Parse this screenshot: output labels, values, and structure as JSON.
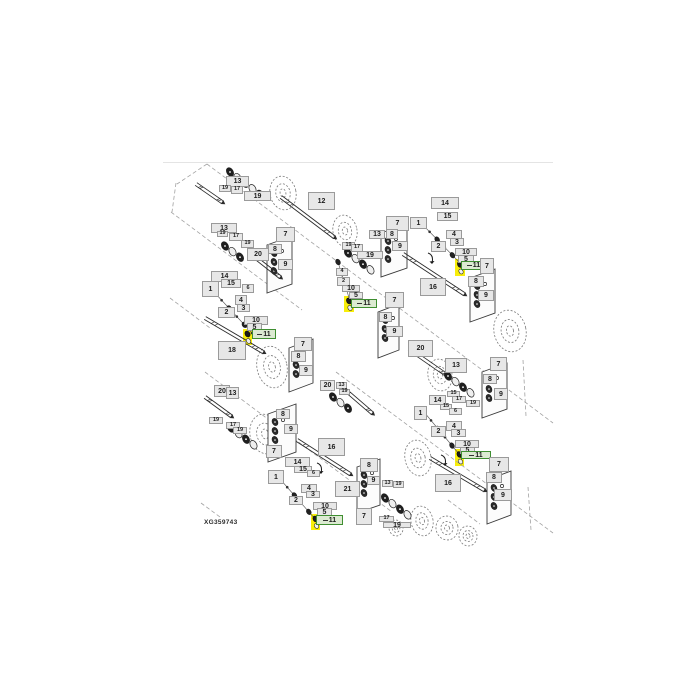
{
  "figure": {
    "code": "XG359743"
  },
  "colors": {
    "box_fill": "#e7e7e7",
    "box_border": "#9a9a9a",
    "highlight_fill": "#dcead2",
    "highlight_border": "#3f8e31",
    "highlight_marker": "#f8ee0a",
    "line": "#2b2b2b",
    "wheel": "#7a7a7a",
    "dash": "#a2a2a2",
    "divider": "#e4e4e4"
  },
  "divider": {
    "x1": 163,
    "y": 162,
    "x2": 553
  },
  "figcode_pos": {
    "x": 204,
    "y": 519
  },
  "callouts": [
    {
      "t": "13",
      "x": 226,
      "y": 176,
      "w": 23,
      "h": 11
    },
    {
      "t": "19",
      "x": 219,
      "y": 185,
      "w": 12,
      "h": 7,
      "k": "s"
    },
    {
      "t": "17",
      "x": 231,
      "y": 186,
      "w": 12,
      "h": 8,
      "k": "s"
    },
    {
      "t": "19",
      "x": 244,
      "y": 191,
      "w": 27,
      "h": 10
    },
    {
      "t": "12",
      "x": 308,
      "y": 192,
      "w": 27,
      "h": 18
    },
    {
      "t": "7",
      "x": 386,
      "y": 216,
      "w": 23,
      "h": 15
    },
    {
      "t": "13",
      "x": 369,
      "y": 230,
      "w": 16,
      "h": 9
    },
    {
      "t": "8",
      "x": 386,
      "y": 229,
      "w": 12,
      "h": 10
    },
    {
      "t": "9",
      "x": 392,
      "y": 241,
      "w": 16,
      "h": 10
    },
    {
      "t": "19",
      "x": 342,
      "y": 242,
      "w": 13,
      "h": 8,
      "k": "s"
    },
    {
      "t": "17",
      "x": 351,
      "y": 244,
      "w": 12,
      "h": 8,
      "k": "s"
    },
    {
      "t": "19",
      "x": 357,
      "y": 251,
      "w": 26,
      "h": 8
    },
    {
      "t": "14",
      "x": 431,
      "y": 197,
      "w": 28,
      "h": 12
    },
    {
      "t": "15",
      "x": 437,
      "y": 212,
      "w": 21,
      "h": 9
    },
    {
      "t": "1",
      "x": 410,
      "y": 217,
      "w": 17,
      "h": 12
    },
    {
      "t": "4",
      "x": 446,
      "y": 230,
      "w": 16,
      "h": 9
    },
    {
      "t": "3",
      "x": 450,
      "y": 238,
      "w": 14,
      "h": 8
    },
    {
      "t": "2",
      "x": 431,
      "y": 241,
      "w": 15,
      "h": 11
    },
    {
      "t": "10",
      "x": 455,
      "y": 248,
      "w": 22,
      "h": 8
    },
    {
      "t": "5",
      "x": 458,
      "y": 255,
      "w": 16,
      "h": 8
    },
    {
      "t": "11",
      "x": 461,
      "y": 261,
      "w": 25,
      "h": 9,
      "k": "h"
    },
    {
      "t": "7",
      "x": 480,
      "y": 258,
      "w": 14,
      "h": 16
    },
    {
      "t": "8",
      "x": 468,
      "y": 276,
      "w": 16,
      "h": 11
    },
    {
      "t": "9",
      "x": 478,
      "y": 290,
      "w": 16,
      "h": 11
    },
    {
      "t": "16",
      "x": 420,
      "y": 278,
      "w": 26,
      "h": 18
    },
    {
      "t": "13",
      "x": 211,
      "y": 223,
      "w": 26,
      "h": 10
    },
    {
      "t": "19",
      "x": 217,
      "y": 231,
      "w": 11,
      "h": 6,
      "k": "s"
    },
    {
      "t": "17",
      "x": 229,
      "y": 233,
      "w": 14,
      "h": 8,
      "k": "s"
    },
    {
      "t": "19",
      "x": 241,
      "y": 240,
      "w": 13,
      "h": 8,
      "k": "s"
    },
    {
      "t": "20",
      "x": 247,
      "y": 248,
      "w": 22,
      "h": 13
    },
    {
      "t": "7",
      "x": 276,
      "y": 227,
      "w": 19,
      "h": 15
    },
    {
      "t": "8",
      "x": 268,
      "y": 244,
      "w": 14,
      "h": 10
    },
    {
      "t": "9",
      "x": 278,
      "y": 259,
      "w": 15,
      "h": 11
    },
    {
      "t": "14",
      "x": 211,
      "y": 271,
      "w": 27,
      "h": 11
    },
    {
      "t": "15",
      "x": 221,
      "y": 279,
      "w": 20,
      "h": 9
    },
    {
      "t": "1",
      "x": 202,
      "y": 281,
      "w": 17,
      "h": 16
    },
    {
      "t": "6",
      "x": 242,
      "y": 284,
      "w": 12,
      "h": 9,
      "k": "s"
    },
    {
      "t": "4",
      "x": 235,
      "y": 295,
      "w": 12,
      "h": 10
    },
    {
      "t": "3",
      "x": 237,
      "y": 304,
      "w": 13,
      "h": 8
    },
    {
      "t": "2",
      "x": 218,
      "y": 307,
      "w": 17,
      "h": 11
    },
    {
      "t": "10",
      "x": 244,
      "y": 316,
      "w": 24,
      "h": 9
    },
    {
      "t": "5",
      "x": 247,
      "y": 323,
      "w": 15,
      "h": 8
    },
    {
      "t": "11",
      "x": 252,
      "y": 329,
      "w": 24,
      "h": 10,
      "k": "h"
    },
    {
      "t": "18",
      "x": 218,
      "y": 341,
      "w": 28,
      "h": 19
    },
    {
      "t": "4",
      "x": 336,
      "y": 268,
      "w": 12,
      "h": 8,
      "k": "s"
    },
    {
      "t": "2",
      "x": 337,
      "y": 277,
      "w": 13,
      "h": 9,
      "k": "s"
    },
    {
      "t": "10",
      "x": 342,
      "y": 285,
      "w": 18,
      "h": 7
    },
    {
      "t": "5",
      "x": 349,
      "y": 292,
      "w": 14,
      "h": 7
    },
    {
      "t": "11",
      "x": 351,
      "y": 299,
      "w": 26,
      "h": 9,
      "k": "h"
    },
    {
      "t": "7",
      "x": 385,
      "y": 292,
      "w": 19,
      "h": 16
    },
    {
      "t": "8",
      "x": 379,
      "y": 312,
      "w": 13,
      "h": 10
    },
    {
      "t": "9",
      "x": 386,
      "y": 326,
      "w": 17,
      "h": 11
    },
    {
      "t": "7",
      "x": 294,
      "y": 337,
      "w": 18,
      "h": 14
    },
    {
      "t": "8",
      "x": 291,
      "y": 351,
      "w": 15,
      "h": 11
    },
    {
      "t": "9",
      "x": 299,
      "y": 365,
      "w": 14,
      "h": 11
    },
    {
      "t": "20",
      "x": 320,
      "y": 380,
      "w": 15,
      "h": 11
    },
    {
      "t": "13",
      "x": 336,
      "y": 382,
      "w": 11,
      "h": 7,
      "k": "s"
    },
    {
      "t": "19",
      "x": 339,
      "y": 389,
      "w": 11,
      "h": 6,
      "k": "s"
    },
    {
      "t": "20",
      "x": 408,
      "y": 340,
      "w": 25,
      "h": 17
    },
    {
      "t": "13",
      "x": 445,
      "y": 358,
      "w": 22,
      "h": 15
    },
    {
      "t": "7",
      "x": 490,
      "y": 357,
      "w": 17,
      "h": 14
    },
    {
      "t": "8",
      "x": 483,
      "y": 374,
      "w": 14,
      "h": 10
    },
    {
      "t": "9",
      "x": 494,
      "y": 388,
      "w": 14,
      "h": 12
    },
    {
      "t": "14",
      "x": 429,
      "y": 395,
      "w": 17,
      "h": 10
    },
    {
      "t": "15",
      "x": 447,
      "y": 391,
      "w": 13,
      "h": 6,
      "k": "s"
    },
    {
      "t": "17",
      "x": 452,
      "y": 396,
      "w": 14,
      "h": 7,
      "k": "s"
    },
    {
      "t": "19",
      "x": 466,
      "y": 400,
      "w": 14,
      "h": 7,
      "k": "s"
    },
    {
      "t": "15",
      "x": 440,
      "y": 404,
      "w": 12,
      "h": 6,
      "k": "s"
    },
    {
      "t": "6",
      "x": 449,
      "y": 408,
      "w": 13,
      "h": 7,
      "k": "s"
    },
    {
      "t": "1",
      "x": 414,
      "y": 406,
      "w": 13,
      "h": 14
    },
    {
      "t": "4",
      "x": 446,
      "y": 421,
      "w": 16,
      "h": 10
    },
    {
      "t": "3",
      "x": 451,
      "y": 429,
      "w": 15,
      "h": 8
    },
    {
      "t": "2",
      "x": 431,
      "y": 426,
      "w": 15,
      "h": 11
    },
    {
      "t": "10",
      "x": 455,
      "y": 440,
      "w": 24,
      "h": 8
    },
    {
      "t": "5",
      "x": 460,
      "y": 447,
      "w": 15,
      "h": 7
    },
    {
      "t": "11",
      "x": 461,
      "y": 451,
      "w": 30,
      "h": 8,
      "k": "h"
    },
    {
      "t": "16",
      "x": 435,
      "y": 474,
      "w": 26,
      "h": 18
    },
    {
      "t": "7",
      "x": 489,
      "y": 457,
      "w": 20,
      "h": 15
    },
    {
      "t": "8",
      "x": 486,
      "y": 472,
      "w": 16,
      "h": 11
    },
    {
      "t": "9",
      "x": 494,
      "y": 489,
      "w": 18,
      "h": 12
    },
    {
      "t": "20",
      "x": 214,
      "y": 385,
      "w": 16,
      "h": 12
    },
    {
      "t": "13",
      "x": 226,
      "y": 387,
      "w": 13,
      "h": 12
    },
    {
      "t": "19",
      "x": 209,
      "y": 417,
      "w": 14,
      "h": 7,
      "k": "s"
    },
    {
      "t": "17",
      "x": 226,
      "y": 422,
      "w": 14,
      "h": 7,
      "k": "s"
    },
    {
      "t": "19",
      "x": 233,
      "y": 427,
      "w": 14,
      "h": 7,
      "k": "s"
    },
    {
      "t": "8",
      "x": 276,
      "y": 409,
      "w": 14,
      "h": 10
    },
    {
      "t": "9",
      "x": 284,
      "y": 424,
      "w": 14,
      "h": 10
    },
    {
      "t": "7",
      "x": 266,
      "y": 445,
      "w": 16,
      "h": 13
    },
    {
      "t": "14",
      "x": 285,
      "y": 457,
      "w": 25,
      "h": 10
    },
    {
      "t": "15",
      "x": 294,
      "y": 466,
      "w": 18,
      "h": 7
    },
    {
      "t": "6",
      "x": 307,
      "y": 470,
      "w": 13,
      "h": 7,
      "k": "s"
    },
    {
      "t": "1",
      "x": 268,
      "y": 470,
      "w": 16,
      "h": 14
    },
    {
      "t": "4",
      "x": 301,
      "y": 484,
      "w": 16,
      "h": 9
    },
    {
      "t": "3",
      "x": 306,
      "y": 491,
      "w": 14,
      "h": 7
    },
    {
      "t": "2",
      "x": 289,
      "y": 496,
      "w": 14,
      "h": 9
    },
    {
      "t": "10",
      "x": 313,
      "y": 502,
      "w": 24,
      "h": 8
    },
    {
      "t": "5",
      "x": 317,
      "y": 508,
      "w": 15,
      "h": 8
    },
    {
      "t": "11",
      "x": 316,
      "y": 515,
      "w": 27,
      "h": 10,
      "k": "h"
    },
    {
      "t": "16",
      "x": 318,
      "y": 438,
      "w": 27,
      "h": 18
    },
    {
      "t": "21",
      "x": 335,
      "y": 481,
      "w": 25,
      "h": 16
    },
    {
      "t": "8",
      "x": 360,
      "y": 458,
      "w": 18,
      "h": 14
    },
    {
      "t": "9",
      "x": 367,
      "y": 476,
      "w": 13,
      "h": 9
    },
    {
      "t": "7",
      "x": 356,
      "y": 508,
      "w": 16,
      "h": 17
    },
    {
      "t": "13",
      "x": 382,
      "y": 480,
      "w": 11,
      "h": 7,
      "k": "s"
    },
    {
      "t": "19",
      "x": 393,
      "y": 481,
      "w": 11,
      "h": 7,
      "k": "s"
    },
    {
      "t": "17",
      "x": 379,
      "y": 516,
      "w": 15,
      "h": 6,
      "k": "s"
    },
    {
      "t": "19",
      "x": 383,
      "y": 522,
      "w": 28,
      "h": 6
    }
  ],
  "markers": [
    {
      "x": 243,
      "y": 329,
      "w": 9,
      "h": 16
    },
    {
      "x": 455,
      "y": 259,
      "w": 10,
      "h": 17
    },
    {
      "x": 344,
      "y": 296,
      "w": 10,
      "h": 16
    },
    {
      "x": 455,
      "y": 449,
      "w": 9,
      "h": 17
    },
    {
      "x": 311,
      "y": 514,
      "w": 9,
      "h": 16
    }
  ],
  "artwork": {
    "wheels": [
      {
        "cx": 283,
        "cy": 193,
        "rx": 13,
        "ry": 17
      },
      {
        "cx": 345,
        "cy": 231,
        "rx": 12,
        "ry": 16
      },
      {
        "cx": 510,
        "cy": 331,
        "rx": 16,
        "ry": 21
      },
      {
        "cx": 272,
        "cy": 367,
        "rx": 15,
        "ry": 21
      },
      {
        "cx": 440,
        "cy": 375,
        "rx": 12,
        "ry": 16
      },
      {
        "cx": 418,
        "cy": 458,
        "rx": 13,
        "ry": 18
      },
      {
        "cx": 265,
        "cy": 434,
        "rx": 15,
        "ry": 20
      },
      {
        "cx": 422,
        "cy": 521,
        "rx": 11,
        "ry": 15
      },
      {
        "cx": 447,
        "cy": 528,
        "rx": 11,
        "ry": 12
      },
      {
        "cx": 468,
        "cy": 536,
        "rx": 9,
        "ry": 10
      },
      {
        "cx": 396,
        "cy": 528,
        "rx": 7,
        "ry": 8
      }
    ],
    "shafts": [
      {
        "x1": 281,
        "y1": 197,
        "x2": 334,
        "y2": 237
      },
      {
        "x1": 403,
        "y1": 254,
        "x2": 464,
        "y2": 294
      },
      {
        "x1": 205,
        "y1": 318,
        "x2": 263,
        "y2": 352
      },
      {
        "x1": 252,
        "y1": 255,
        "x2": 280,
        "y2": 277
      },
      {
        "x1": 409,
        "y1": 349,
        "x2": 448,
        "y2": 376
      },
      {
        "x1": 343,
        "y1": 388,
        "x2": 372,
        "y2": 413
      },
      {
        "x1": 430,
        "y1": 458,
        "x2": 484,
        "y2": 490
      },
      {
        "x1": 297,
        "y1": 440,
        "x2": 350,
        "y2": 474
      },
      {
        "x1": 205,
        "y1": 397,
        "x2": 231,
        "y2": 416
      },
      {
        "x1": 196,
        "y1": 184,
        "x2": 222,
        "y2": 202
      }
    ],
    "panels": [
      {
        "x": 267,
        "y": 236,
        "w": 25,
        "h": 48
      },
      {
        "x": 381,
        "y": 224,
        "w": 26,
        "h": 44
      },
      {
        "x": 470,
        "y": 269,
        "w": 25,
        "h": 44
      },
      {
        "x": 378,
        "y": 304,
        "w": 21,
        "h": 46
      },
      {
        "x": 289,
        "y": 339,
        "w": 24,
        "h": 44
      },
      {
        "x": 482,
        "y": 363,
        "w": 25,
        "h": 46
      },
      {
        "x": 487,
        "y": 471,
        "w": 24,
        "h": 44
      },
      {
        "x": 268,
        "y": 404,
        "w": 28,
        "h": 48
      },
      {
        "x": 357,
        "y": 459,
        "w": 23,
        "h": 46
      }
    ],
    "clusters": [
      {
        "x": 230,
        "y": 172,
        "n": 5
      },
      {
        "x": 225,
        "y": 246,
        "n": 3
      },
      {
        "x": 348,
        "y": 253,
        "n": 4
      },
      {
        "x": 448,
        "y": 376,
        "n": 4
      },
      {
        "x": 231,
        "y": 428,
        "n": 4
      },
      {
        "x": 385,
        "y": 498,
        "n": 4
      },
      {
        "x": 333,
        "y": 397,
        "n": 3
      }
    ],
    "chains": [
      {
        "x1": 214,
        "y1": 292,
        "x2": 252,
        "y2": 333,
        "n": 6
      },
      {
        "x1": 422,
        "y1": 224,
        "x2": 460,
        "y2": 263,
        "n": 6
      },
      {
        "x1": 338,
        "y1": 262,
        "x2": 350,
        "y2": 301,
        "n": 4
      },
      {
        "x1": 424,
        "y1": 412,
        "x2": 459,
        "y2": 454,
        "n": 6
      },
      {
        "x1": 280,
        "y1": 479,
        "x2": 316,
        "y2": 520,
        "n": 6
      }
    ],
    "dashes": [
      {
        "x1": 207,
        "y1": 164,
        "x2": 553,
        "y2": 423
      },
      {
        "x1": 171,
        "y1": 212,
        "x2": 302,
        "y2": 310
      },
      {
        "x1": 170,
        "y1": 298,
        "x2": 210,
        "y2": 328
      },
      {
        "x1": 205,
        "y1": 372,
        "x2": 392,
        "y2": 512
      },
      {
        "x1": 336,
        "y1": 372,
        "x2": 553,
        "y2": 533
      },
      {
        "x1": 523,
        "y1": 360,
        "x2": 526,
        "y2": 416
      },
      {
        "x1": 528,
        "y1": 487,
        "x2": 531,
        "y2": 530
      },
      {
        "x1": 176,
        "y1": 183,
        "x2": 172,
        "y2": 212
      },
      {
        "x1": 207,
        "y1": 164,
        "x2": 177,
        "y2": 184
      },
      {
        "x1": 448,
        "y1": 500,
        "x2": 480,
        "y2": 524
      },
      {
        "x1": 201,
        "y1": 503,
        "x2": 220,
        "y2": 517
      }
    ],
    "arcs": [
      {
        "x": 431,
        "y": 259
      },
      {
        "x": 320,
        "y": 469
      },
      {
        "x": 444,
        "y": 461
      }
    ]
  }
}
